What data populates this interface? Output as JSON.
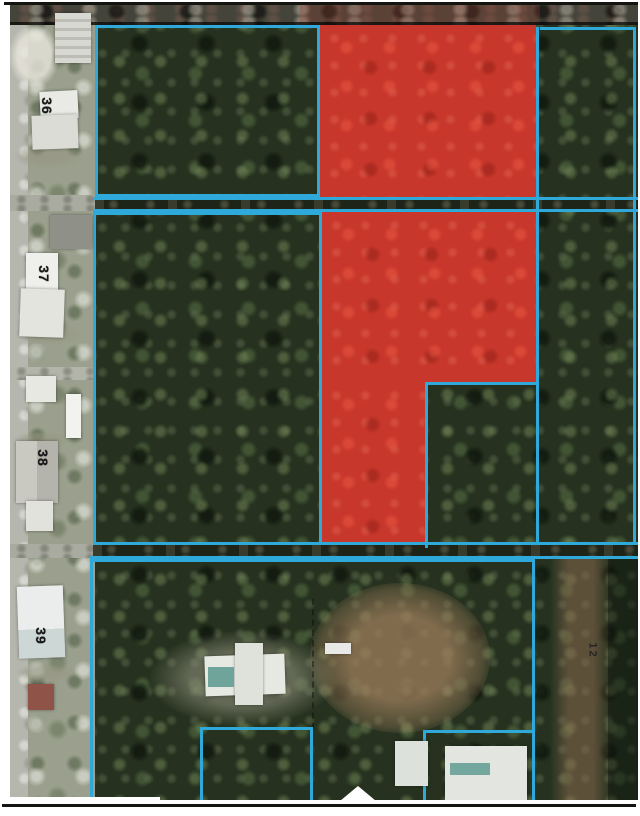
{
  "map": {
    "type": "aerial-parcel-map",
    "colors": {
      "highlight_red": "#c8372b",
      "boundary_cyan": "#2ea9da",
      "forest_green": "#26321f",
      "road_gray": "#9aa08d",
      "scan_line_black": "#141410"
    },
    "parcel_labels": [
      {
        "text": "36"
      },
      {
        "text": "37"
      },
      {
        "text": "38"
      },
      {
        "text": "39"
      }
    ],
    "trail_label": {
      "text": "12"
    }
  }
}
